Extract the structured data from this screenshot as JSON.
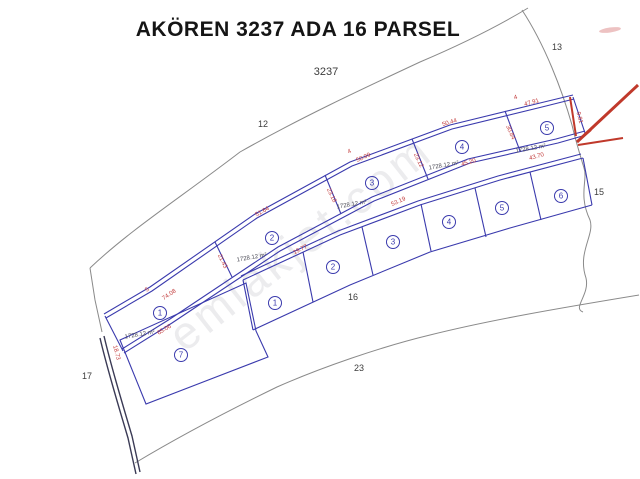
{
  "title": "AKÖREN 3237 ADA 16 PARSEL",
  "watermark": "emlakjet.com",
  "map": {
    "block_label": "3237",
    "neighbor_parcels": {
      "n12": "12",
      "n13": "13",
      "n15": "15",
      "n16": "16",
      "n17": "17",
      "n23": "23"
    },
    "area_label": "1728.12 m²",
    "parcels": {
      "upper_row": [
        "1",
        "2",
        "3",
        "4",
        "5"
      ],
      "lower_row": [
        "1",
        "2",
        "3",
        "4",
        "5",
        "6"
      ],
      "bottom_left": "7"
    },
    "measurements": [
      "5",
      "74.08",
      "65.06",
      "21.43",
      "51.64",
      "19.77",
      "23.18",
      "4",
      "50.09",
      "53.19",
      "23.12",
      "50.44",
      "45.20",
      "30.84",
      "4",
      "47.91",
      "43.70",
      "9.81",
      "18.73"
    ]
  },
  "colors": {
    "parcel_line": "#3a3aad",
    "boundary_line": "#8a8a8a",
    "measurement_text": "#c23b3b",
    "annotation_arrow": "#c0392b",
    "label_text": "#3c3c3c"
  }
}
